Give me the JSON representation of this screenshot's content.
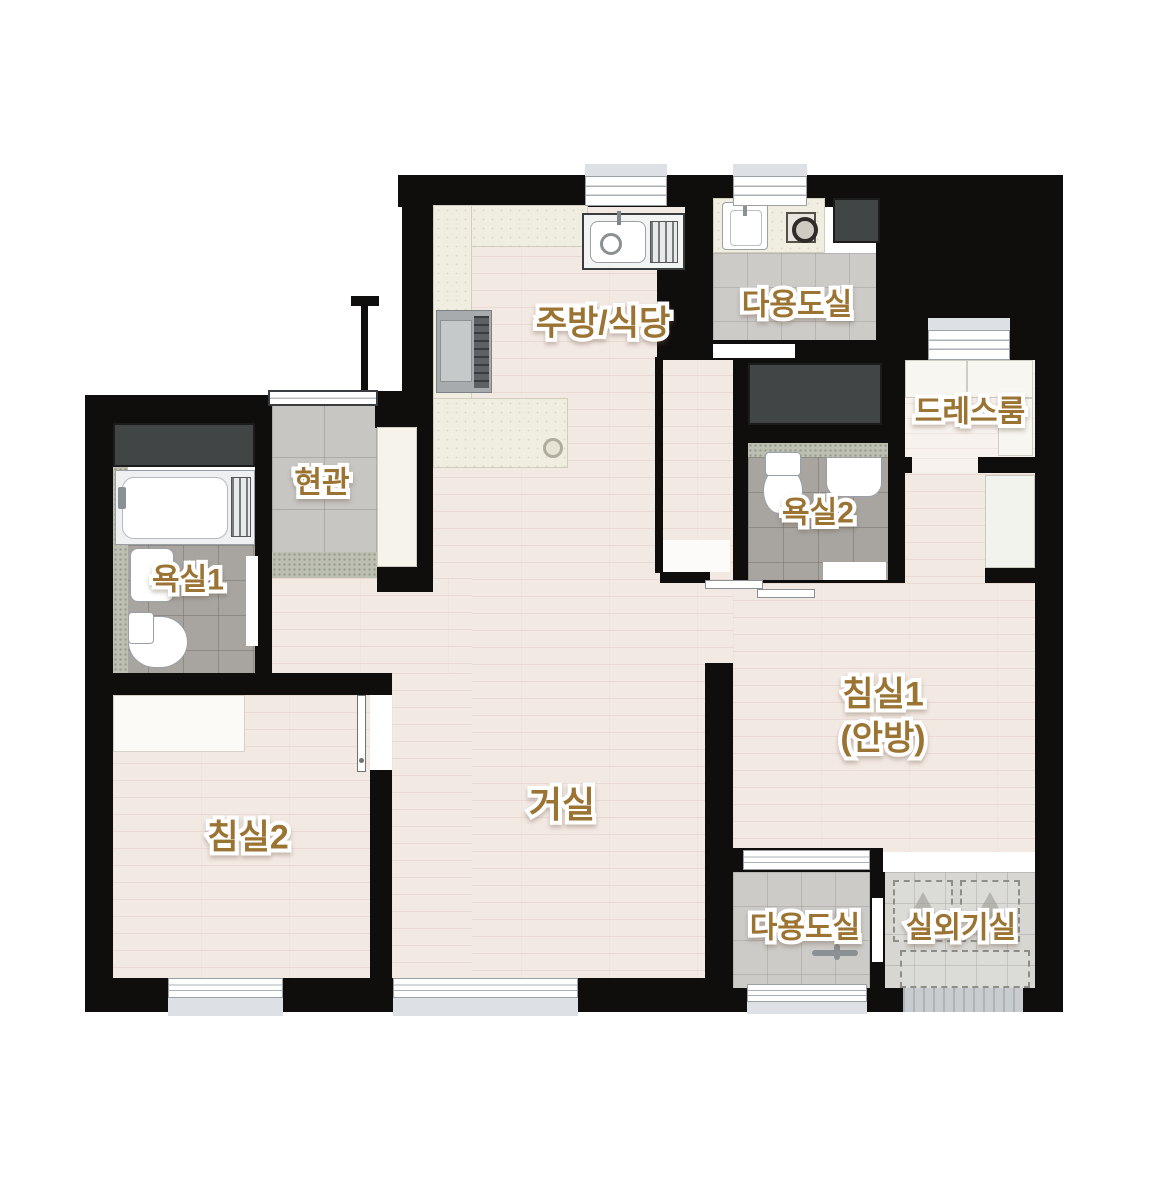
{
  "floor_plan": {
    "labels": {
      "kitchen_dining": "주방/식당",
      "utility_top": "다용도실",
      "dressroom": "드레스룸",
      "entrance": "현관",
      "bathroom1": "욕실1",
      "bathroom2": "욕실2",
      "bedroom1_line1": "침실1",
      "bedroom1_line2": "(안방)",
      "living": "거실",
      "bedroom2": "침실2",
      "utility_bottom": "다용도실",
      "ac_room": "실외기실"
    },
    "colors": {
      "wall": "#100d0d",
      "label": "#9b7434",
      "wood": "#f3e9e3",
      "wood_light": "#f8f2ee",
      "tile": "#c7c6c3",
      "tile_bath": "#a8a5a1",
      "tile_ac": "#d7d6d3",
      "counter": "#f0ede1",
      "granite": "#bcbfb2",
      "dark_panel": "#424545",
      "sill": "#dde0e4"
    }
  }
}
